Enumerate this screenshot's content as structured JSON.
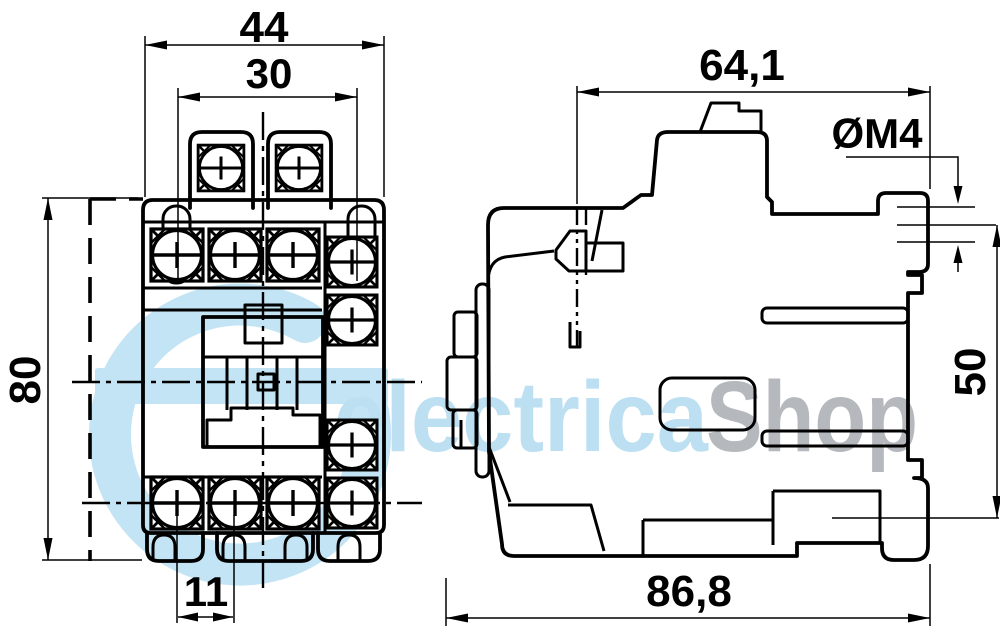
{
  "drawing": {
    "type": "contactor-dimensional-drawing",
    "front_view": {
      "width_overall_mm": "44",
      "width_mounting_mm": "30",
      "height_overall_mm": "80",
      "terminal_pitch_mm": "11"
    },
    "side_view": {
      "depth_upper_mm": "64,1",
      "mounting_screw": "ØM4",
      "mounting_height_mm": "50",
      "depth_overall_mm": "86,8"
    }
  },
  "watermark": {
    "brand_left": "electrica",
    "brand_right": "Shop",
    "left_color": "#bcdff1",
    "right_color": "#b5b8bc",
    "logo_color": "#c3e4f4"
  },
  "colors": {
    "line": "#000000",
    "background": "#ffffff"
  }
}
